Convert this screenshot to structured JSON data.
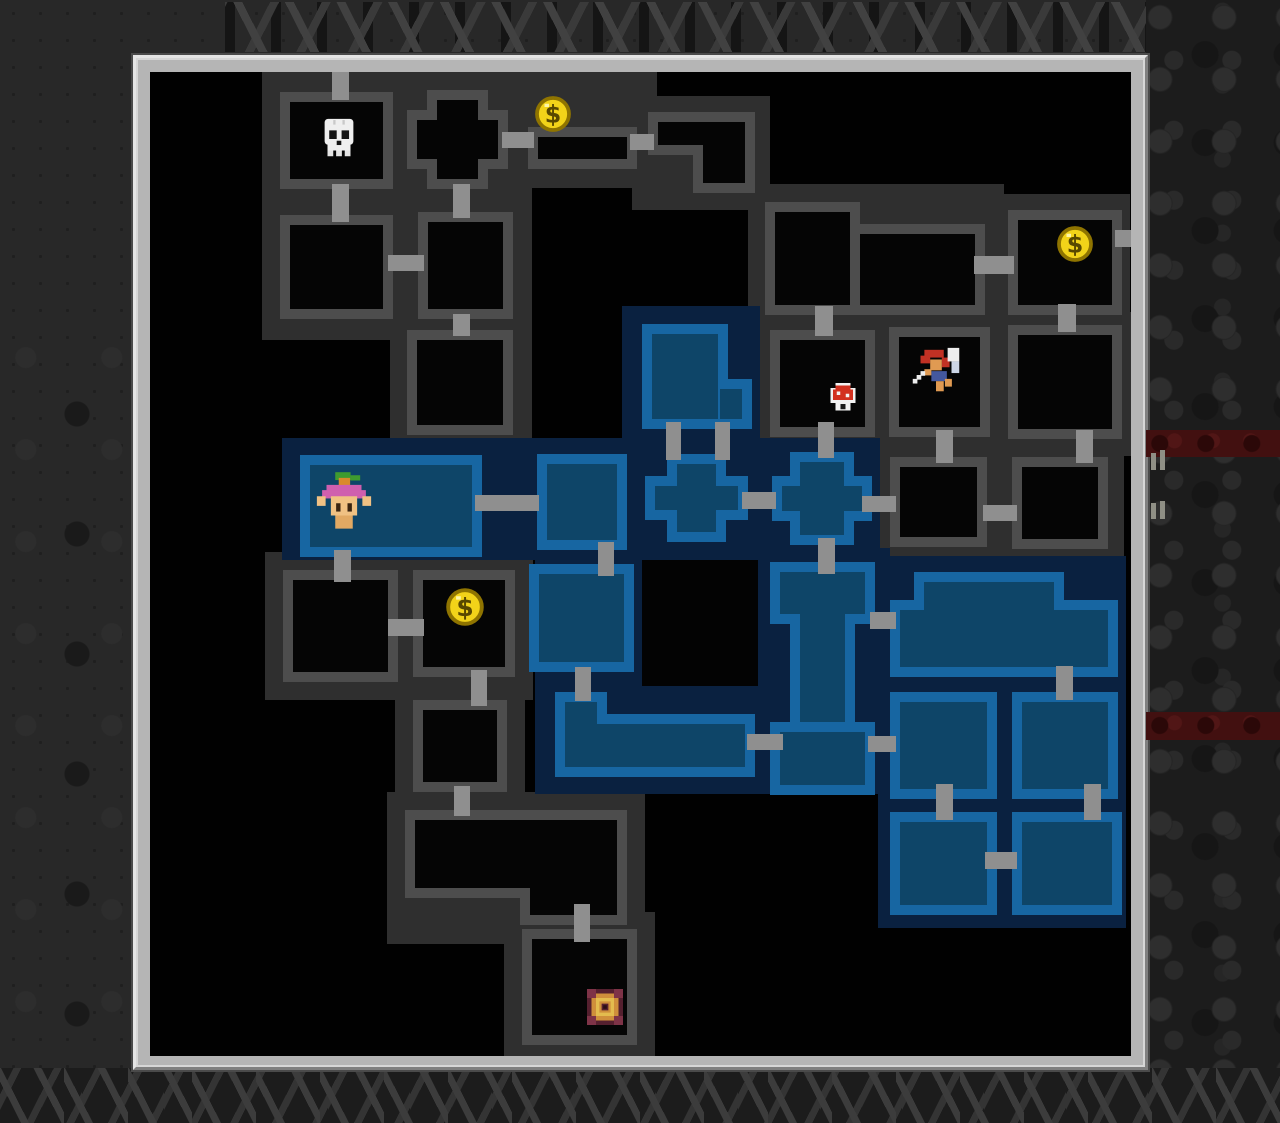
{
  "app": {
    "name": "dungeon-minimap-overlay",
    "visible_text": ""
  },
  "colors": {
    "bg": "#282828",
    "frame": "#b5b5b5",
    "frame_light": "#e4e4e4",
    "frame_dark": "#7f7f7f",
    "map_bg": "#010101",
    "cluster_gray": "#2f2f2f",
    "wall_gray": "#4d4d4d",
    "room_black": "#050505",
    "cluster_blue": "#0a2140",
    "wall_blue": "#1766a2",
    "room_blue": "#0e4568",
    "corridor": "#8f8f8f",
    "coin_gold": "#f2d319",
    "stripe_red": "#421010"
  },
  "frame": {
    "x": 133,
    "y": 55,
    "w": 1015,
    "h": 1015,
    "interior": {
      "dx": 14,
      "dy": 14,
      "w": 981,
      "h": 984
    }
  },
  "background": {
    "arch_row": [
      225,
      2,
      940,
      50
    ],
    "right_band": [
      1146,
      0,
      134,
      1123
    ],
    "bottom_band": [
      0,
      1068,
      1280,
      55
    ],
    "left_rocks": [
      0,
      330,
      133,
      740
    ],
    "red_stripes": [
      [
        1146,
        430,
        134,
        27
      ],
      [
        1146,
        712,
        134,
        28
      ]
    ],
    "pillars": [
      [
        1151,
        453,
        5,
        17
      ],
      [
        1160,
        450,
        5,
        20
      ],
      [
        1151,
        503,
        5,
        16
      ],
      [
        1160,
        501,
        5,
        18
      ]
    ]
  },
  "map": {
    "backdrops": [
      {
        "style": "gray",
        "r": [
          112,
          0,
          152,
          268
        ]
      },
      {
        "style": "gray",
        "r": [
          240,
          0,
          142,
          388
        ]
      },
      {
        "style": "gray",
        "r": [
          362,
          0,
          145,
          116
        ]
      },
      {
        "style": "gray",
        "r": [
          482,
          24,
          138,
          114
        ]
      },
      {
        "style": "gray",
        "r": [
          598,
          112,
          256,
          150
        ]
      },
      {
        "style": "gray",
        "r": [
          840,
          122,
          140,
          140
        ]
      },
      {
        "style": "gray",
        "r": [
          602,
          240,
          386,
          144
        ]
      },
      {
        "style": "gray",
        "r": [
          722,
          368,
          252,
          120
        ]
      },
      {
        "style": "gray",
        "r": [
          115,
          480,
          268,
          148
        ]
      },
      {
        "style": "gray",
        "r": [
          245,
          610,
          130,
          148
        ]
      },
      {
        "style": "gray",
        "r": [
          237,
          720,
          258,
          152
        ]
      },
      {
        "style": "gray",
        "r": [
          354,
          840,
          151,
          150
        ]
      },
      {
        "style": "blue",
        "r": [
          132,
          366,
          598,
          122
        ]
      },
      {
        "style": "blue",
        "r": [
          472,
          234,
          138,
          136
        ]
      },
      {
        "style": "blue",
        "r": [
          385,
          476,
          355,
          246
        ]
      },
      {
        "style": "blue",
        "r": [
          728,
          484,
          248,
          372
        ]
      }
    ],
    "black_patches": [
      [
        492,
        488,
        116,
        126
      ]
    ],
    "rooms": [
      {
        "id": "room-skull",
        "style": "gray",
        "rects": [
          [
            130,
            20,
            113,
            97
          ]
        ],
        "icon": "skull",
        "icon_box": [
          166,
          44,
          46
        ]
      },
      {
        "id": "room-below-skull",
        "style": "gray",
        "rects": [
          [
            130,
            143,
            113,
            104
          ]
        ]
      },
      {
        "id": "room-cross-top",
        "style": "gray",
        "rects": [
          [
            277,
            18,
            61,
            99
          ],
          [
            257,
            38,
            101,
            59
          ]
        ]
      },
      {
        "id": "room-col2-row1",
        "style": "gray",
        "rects": [
          [
            268,
            140,
            95,
            107
          ]
        ]
      },
      {
        "id": "room-col2-row2",
        "style": "gray",
        "rects": [
          [
            257,
            258,
            106,
            105
          ]
        ]
      },
      {
        "id": "room-coin-top",
        "style": "gray",
        "rects": [
          [
            378,
            55,
            109,
            42
          ]
        ],
        "icon": "coin",
        "icon_box": [
          383,
          22,
          40
        ]
      },
      {
        "id": "room-l-shape",
        "style": "gray",
        "rects": [
          [
            498,
            40,
            107,
            43
          ],
          [
            543,
            40,
            62,
            81
          ]
        ]
      },
      {
        "id": "room-wide-topright",
        "style": "gray",
        "rects": [
          [
            615,
            130,
            95,
            113
          ],
          [
            700,
            152,
            135,
            91
          ]
        ]
      },
      {
        "id": "room-coin-right",
        "style": "gray",
        "rects": [
          [
            858,
            138,
            114,
            105
          ]
        ],
        "icon": "coin",
        "icon_box": [
          905,
          152,
          40
        ]
      },
      {
        "id": "room-mushroom",
        "style": "gray",
        "rects": [
          [
            620,
            258,
            105,
            107
          ]
        ],
        "icon": "mushroom",
        "icon_box": [
          673,
          306,
          40
        ]
      },
      {
        "id": "room-warrior",
        "style": "gray",
        "rects": [
          [
            739,
            255,
            101,
            110
          ]
        ],
        "icon": "warrior",
        "icon_box": [
          755,
          272,
          62
        ]
      },
      {
        "id": "room-right-row2",
        "style": "gray",
        "rects": [
          [
            858,
            253,
            114,
            114
          ]
        ]
      },
      {
        "id": "room-mid-row3a",
        "style": "gray",
        "rects": [
          [
            740,
            385,
            97,
            90
          ]
        ]
      },
      {
        "id": "room-mid-row3b",
        "style": "gray",
        "rects": [
          [
            862,
            385,
            96,
            92
          ]
        ]
      },
      {
        "id": "room-left-row4",
        "style": "gray",
        "rects": [
          [
            133,
            498,
            115,
            112
          ]
        ]
      },
      {
        "id": "room-coin-mid",
        "style": "gray",
        "rects": [
          [
            263,
            498,
            102,
            107
          ]
        ],
        "icon": "coin",
        "icon_box": [
          294,
          514,
          42
        ]
      },
      {
        "id": "room-below-coinmid",
        "style": "gray",
        "rects": [
          [
            263,
            628,
            94,
            92
          ]
        ]
      },
      {
        "id": "room-wide-bottom",
        "style": "gray",
        "rects": [
          [
            255,
            738,
            222,
            88
          ],
          [
            370,
            738,
            107,
            115
          ]
        ]
      },
      {
        "id": "room-stairs",
        "style": "gray",
        "rects": [
          [
            372,
            857,
            115,
            116
          ]
        ],
        "icon": "stairs",
        "icon_box": [
          437,
          917,
          36
        ]
      },
      {
        "id": "room-elf",
        "style": "blue",
        "rects": [
          [
            150,
            383,
            182,
            102
          ]
        ],
        "icon": "elf",
        "icon_box": [
          159,
          398,
          70
        ]
      },
      {
        "id": "room-blue-mid",
        "style": "blue",
        "rects": [
          [
            387,
            382,
            90,
            96
          ]
        ]
      },
      {
        "id": "room-blue-t",
        "style": "blue",
        "rects": [
          [
            492,
            252,
            86,
            105
          ],
          [
            560,
            307,
            42,
            50
          ]
        ]
      },
      {
        "id": "room-blue-cross1",
        "style": "blue",
        "rects": [
          [
            517,
            382,
            59,
            88
          ],
          [
            495,
            404,
            103,
            44
          ]
        ]
      },
      {
        "id": "room-blue-cross2",
        "style": "blue",
        "rects": [
          [
            640,
            380,
            64,
            93
          ],
          [
            622,
            404,
            100,
            45
          ]
        ]
      },
      {
        "id": "room-blue-a4",
        "style": "blue",
        "rects": [
          [
            379,
            492,
            105,
            108
          ]
        ]
      },
      {
        "id": "room-blue-ibeam",
        "style": "blue",
        "rects": [
          [
            620,
            490,
            105,
            62
          ],
          [
            640,
            530,
            65,
            130
          ],
          [
            620,
            650,
            105,
            73
          ]
        ]
      },
      {
        "id": "room-blue-wide",
        "style": "blue",
        "rects": [
          [
            405,
            620,
            52,
            85
          ],
          [
            405,
            642,
            200,
            63
          ]
        ]
      },
      {
        "id": "room-blue-big",
        "style": "blue",
        "rects": [
          [
            740,
            528,
            228,
            77
          ],
          [
            764,
            500,
            150,
            105
          ]
        ]
      },
      {
        "id": "room-blue-f1",
        "style": "blue",
        "rects": [
          [
            740,
            620,
            107,
            107
          ]
        ]
      },
      {
        "id": "room-blue-f2",
        "style": "blue",
        "rects": [
          [
            862,
            620,
            106,
            107
          ]
        ]
      },
      {
        "id": "room-blue-g1",
        "style": "blue",
        "rects": [
          [
            740,
            740,
            107,
            103
          ]
        ]
      },
      {
        "id": "room-blue-g2",
        "style": "blue",
        "rects": [
          [
            862,
            740,
            110,
            103
          ]
        ]
      }
    ],
    "corridors": [
      [
        182,
        0,
        17,
        28
      ],
      [
        182,
        112,
        17,
        38
      ],
      [
        352,
        60,
        32,
        16
      ],
      [
        480,
        62,
        24,
        16
      ],
      [
        303,
        112,
        17,
        34
      ],
      [
        238,
        183,
        36,
        16
      ],
      [
        303,
        242,
        17,
        22
      ],
      [
        665,
        234,
        18,
        30
      ],
      [
        824,
        184,
        40,
        18
      ],
      [
        908,
        232,
        18,
        28
      ],
      [
        965,
        158,
        22,
        17
      ],
      [
        786,
        358,
        17,
        33
      ],
      [
        926,
        358,
        17,
        33
      ],
      [
        833,
        433,
        34,
        16
      ],
      [
        712,
        424,
        34,
        16
      ],
      [
        668,
        350,
        16,
        36
      ],
      [
        592,
        420,
        34,
        17
      ],
      [
        516,
        350,
        15,
        38
      ],
      [
        565,
        350,
        15,
        38
      ],
      [
        325,
        423,
        64,
        16
      ],
      [
        184,
        478,
        17,
        32
      ],
      [
        448,
        470,
        16,
        34
      ],
      [
        238,
        547,
        36,
        17
      ],
      [
        321,
        598,
        16,
        36
      ],
      [
        304,
        714,
        16,
        30
      ],
      [
        424,
        832,
        16,
        38
      ],
      [
        425,
        595,
        16,
        34
      ],
      [
        597,
        662,
        36,
        16
      ],
      [
        668,
        466,
        17,
        36
      ],
      [
        720,
        540,
        26,
        17
      ],
      [
        718,
        664,
        28,
        16
      ],
      [
        906,
        594,
        17,
        34
      ],
      [
        786,
        712,
        17,
        36
      ],
      [
        934,
        712,
        17,
        36
      ],
      [
        835,
        780,
        32,
        17
      ]
    ]
  },
  "icons_present": [
    "skull",
    "coin",
    "mushroom",
    "warrior",
    "elf",
    "stairs"
  ]
}
